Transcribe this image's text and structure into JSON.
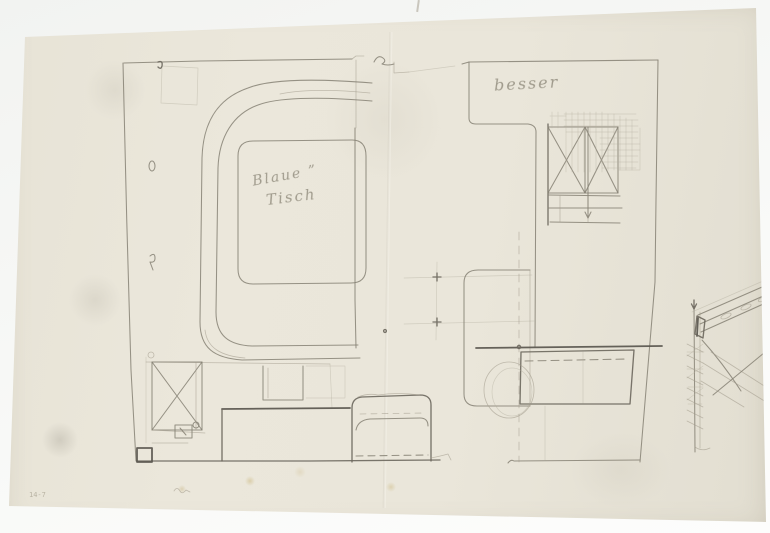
{
  "scene": {
    "description": "Pencil architectural sketch (two furniture floor plans and a wall-section detail) on a cream sheet of paper photographed on a light background",
    "background_color": "#f5f6f4",
    "paper_color": "#e9e5d9",
    "pencil_color": "#7b776c"
  },
  "annotations": {
    "table_label_line1": "Blaue ”",
    "table_label_line2": "Tisch",
    "note_right_plan": "besser",
    "inventory_number": "14-7"
  }
}
